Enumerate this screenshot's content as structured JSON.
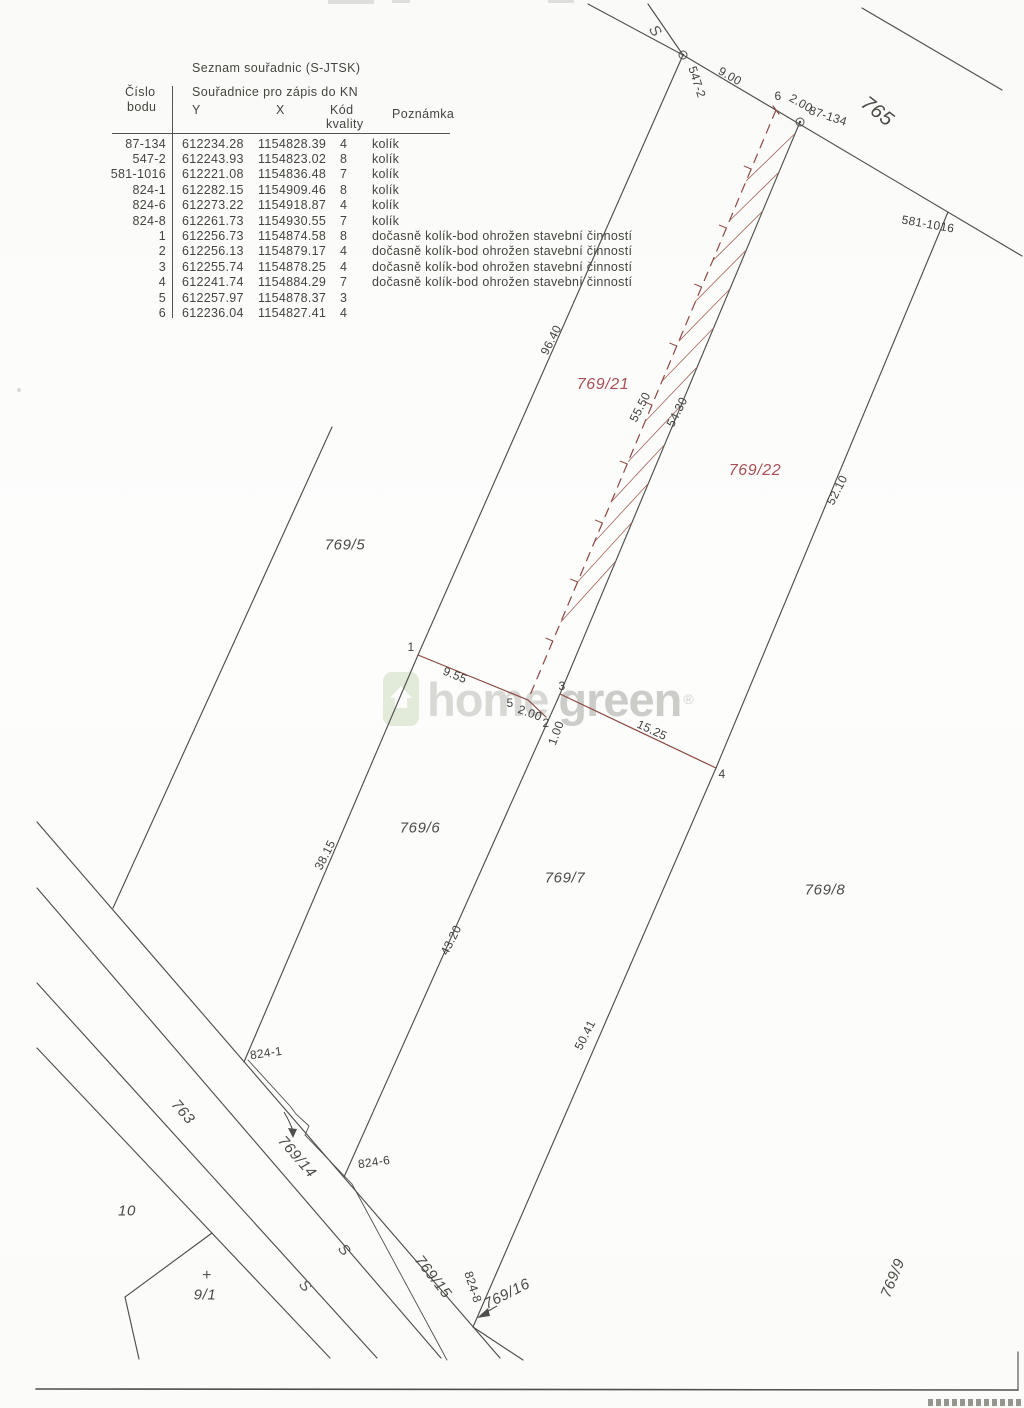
{
  "table": {
    "title": "Seznam souřadnic (S-JTSK)",
    "header": {
      "point_line1": "Číslo",
      "point_line2": "bodu",
      "coords": "Souřadnice pro zápis do KN",
      "y": "Y",
      "x": "X",
      "quality_line1": "Kód",
      "quality_line2": "kvality",
      "note": "Poznámka"
    },
    "rows": [
      {
        "point": "87-134",
        "y": "612234.28",
        "x": "1154828.39",
        "quality": "4",
        "note": "kolík"
      },
      {
        "point": "547-2",
        "y": "612243.93",
        "x": "1154823.02",
        "quality": "8",
        "note": "kolík"
      },
      {
        "point": "581-1016",
        "y": "612221.08",
        "x": "1154836.48",
        "quality": "7",
        "note": "kolík"
      },
      {
        "point": "824-1",
        "y": "612282.15",
        "x": "1154909.46",
        "quality": "8",
        "note": "kolík"
      },
      {
        "point": "824-6",
        "y": "612273.22",
        "x": "1154918.87",
        "quality": "4",
        "note": "kolík"
      },
      {
        "point": "824-8",
        "y": "612261.73",
        "x": "1154930.55",
        "quality": "7",
        "note": "kolík"
      },
      {
        "point": "1",
        "y": "612256.73",
        "x": "1154874.58",
        "quality": "8",
        "note": "dočasně kolík-bod ohrožen stavební činností"
      },
      {
        "point": "2",
        "y": "612256.13",
        "x": "1154879.17",
        "quality": "4",
        "note": "dočasně kolík-bod ohrožen stavební činností"
      },
      {
        "point": "3",
        "y": "612255.74",
        "x": "1154878.25",
        "quality": "4",
        "note": "dočasně kolík-bod ohrožen stavební činností"
      },
      {
        "point": "4",
        "y": "612241.74",
        "x": "1154884.29",
        "quality": "7",
        "note": "dočasně kolík-bod ohrožen stavební činností"
      },
      {
        "point": "5",
        "y": "612257.97",
        "x": "1154878.37",
        "quality": "3",
        "note": ""
      },
      {
        "point": "6",
        "y": "612236.04",
        "x": "1154827.41",
        "quality": "4",
        "note": ""
      }
    ]
  },
  "map": {
    "parcel_labels": {
      "p769_5": "769/5",
      "p769_6": "769/6",
      "p769_7": "769/7",
      "p769_8": "769/8",
      "p769_9": "769/9",
      "p769_14": "769/14",
      "p769_15": "769/15",
      "p769_16": "769/16",
      "p769_21": "769/21",
      "p769_22": "769/22",
      "p763": "763",
      "p765": "765",
      "p10": "10",
      "p9_1": "9/1"
    },
    "point_labels": {
      "pt87_134": "87-134",
      "pt547_2": "547-2",
      "pt581_1016": "581-1016",
      "pt824_1": "824-1",
      "pt824_6": "824-6",
      "pt824_8": "824-8",
      "pt1": "1",
      "pt2": "2",
      "pt3": "3",
      "pt4": "4",
      "pt5": "5",
      "pt6": "6"
    },
    "measurements": {
      "m9_00": "9.00",
      "m2_00a": "2.00",
      "m9_55": "9.55",
      "m2_00b": "2.00",
      "m1_00": "1.00",
      "m15_25": "15.25",
      "m38_15": "38.15",
      "m43_20": "43.20",
      "m50_41": "50.41",
      "m52_10": "52.10",
      "m96_40": "96.40",
      "m55_50": "55.50",
      "m54_30": "54.30"
    },
    "symbols": {
      "merge_mark": "S",
      "cross_mark": "+"
    },
    "colors": {
      "ink": "#4f4f4c",
      "new_boundary_red": "#8b4843",
      "hatch_red": "#a2635c",
      "new_parcel_label_red": "#a84f56",
      "watermark_gray": "#d8d8d4",
      "watermark_green": "#e2ead9"
    }
  },
  "watermark": {
    "word1": "home",
    "word2": "green",
    "reg": "®"
  }
}
